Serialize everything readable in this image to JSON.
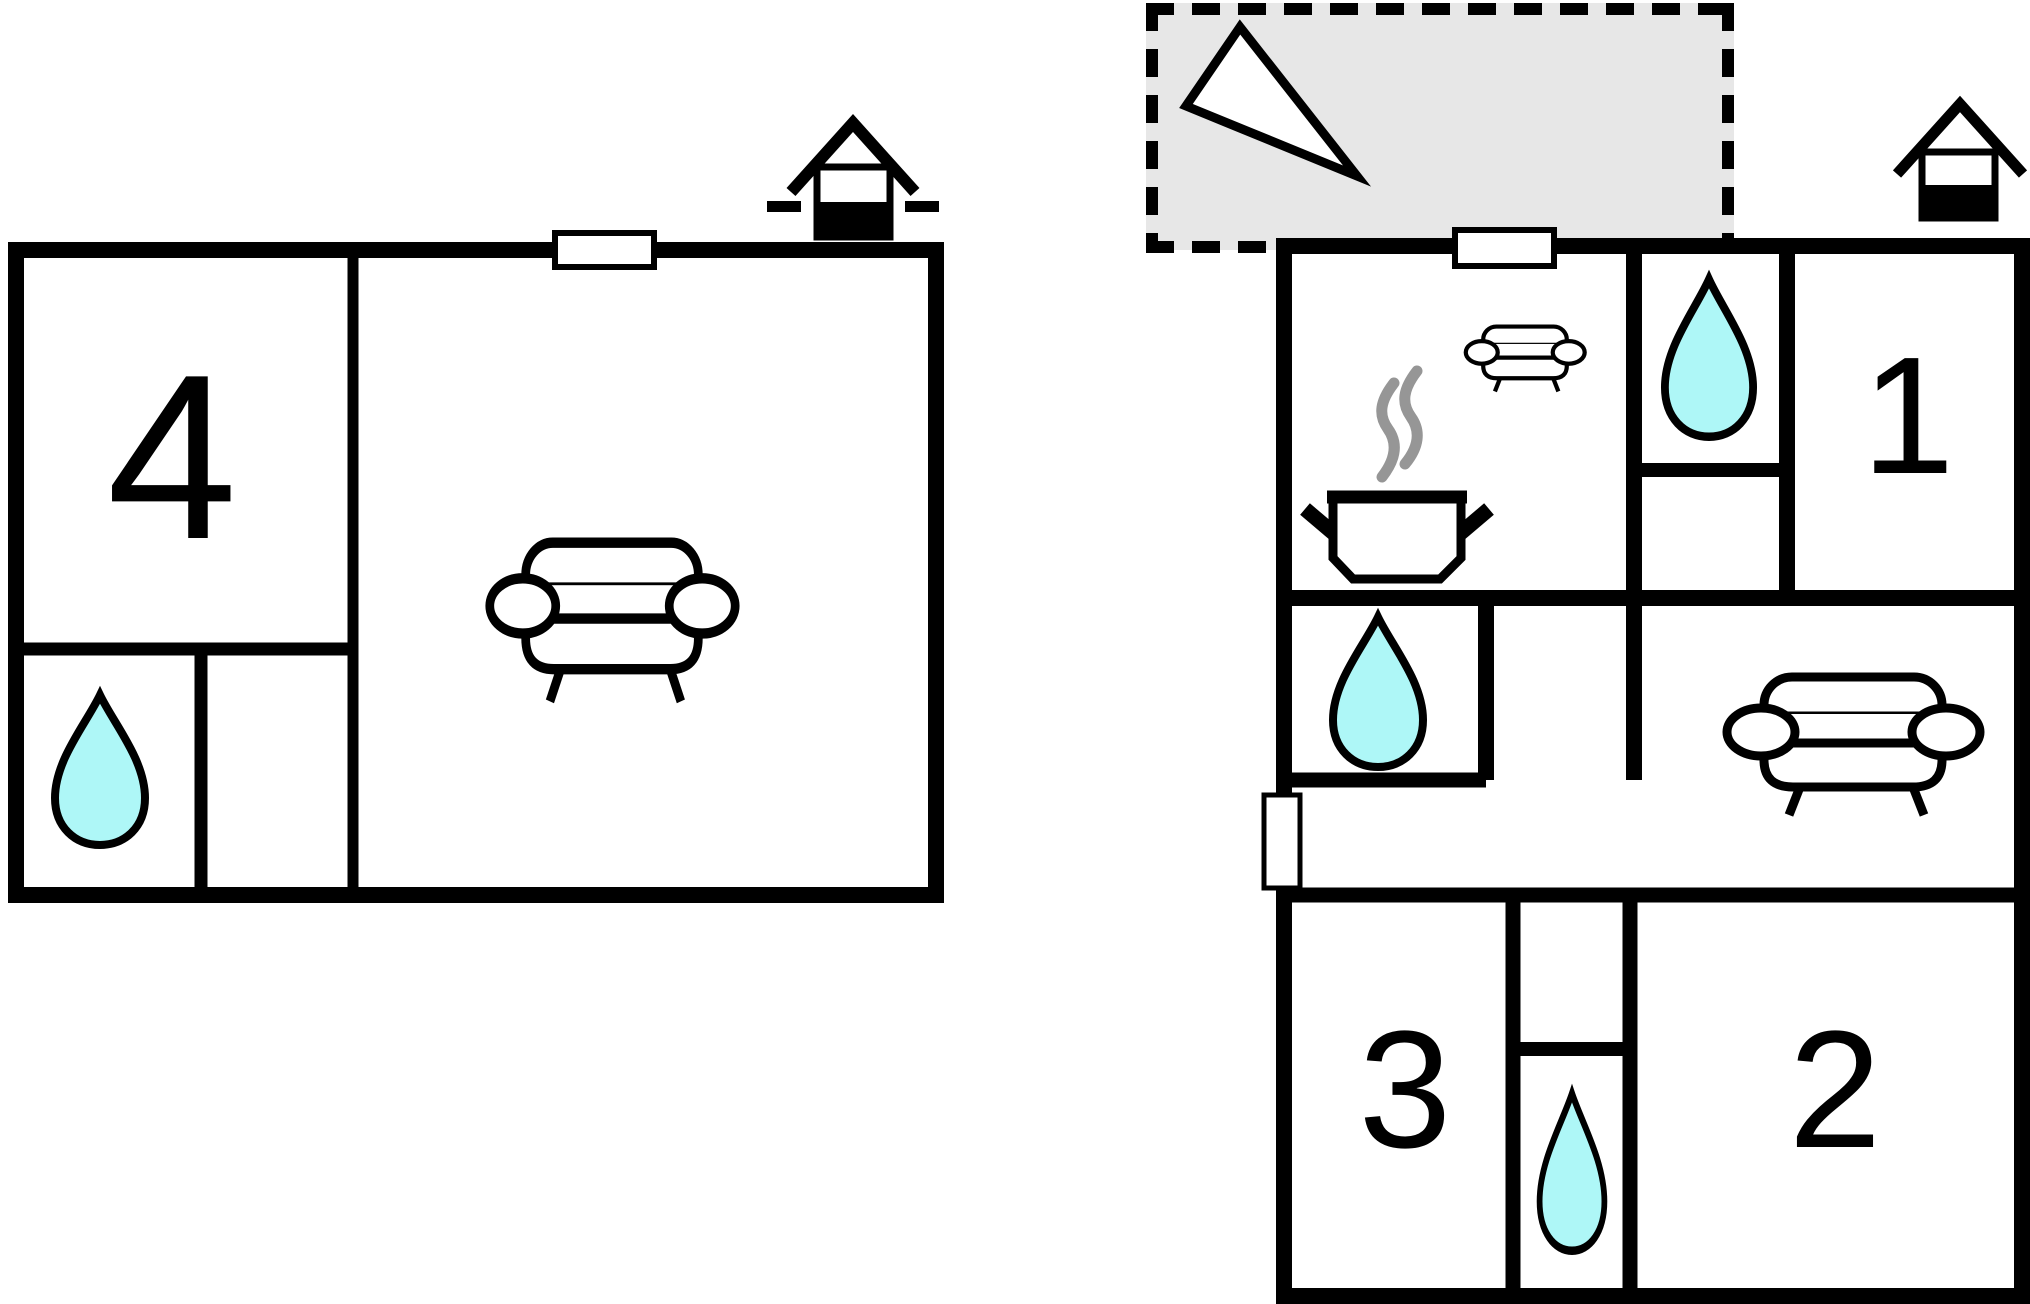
{
  "title": "holiday-home-floor-plan",
  "labels": {
    "room1": "1",
    "room2": "2",
    "room3": "3",
    "room4": "4"
  },
  "colors": {
    "water": "#aef7f7",
    "terrace": "#e7e7e7",
    "steam": "#969696",
    "wall": "#000000",
    "paper": "#ffffff"
  },
  "icons": {
    "water_drop": "teardrop",
    "sofa": "sofa-with-armrests",
    "cooking_pot": "pot-with-steam",
    "house_marker": "house-roof-with-chimney-box",
    "north_arrow": "triangle-pointer",
    "window": "white-rect-in-wall",
    "door": "white-rect-in-wall"
  }
}
